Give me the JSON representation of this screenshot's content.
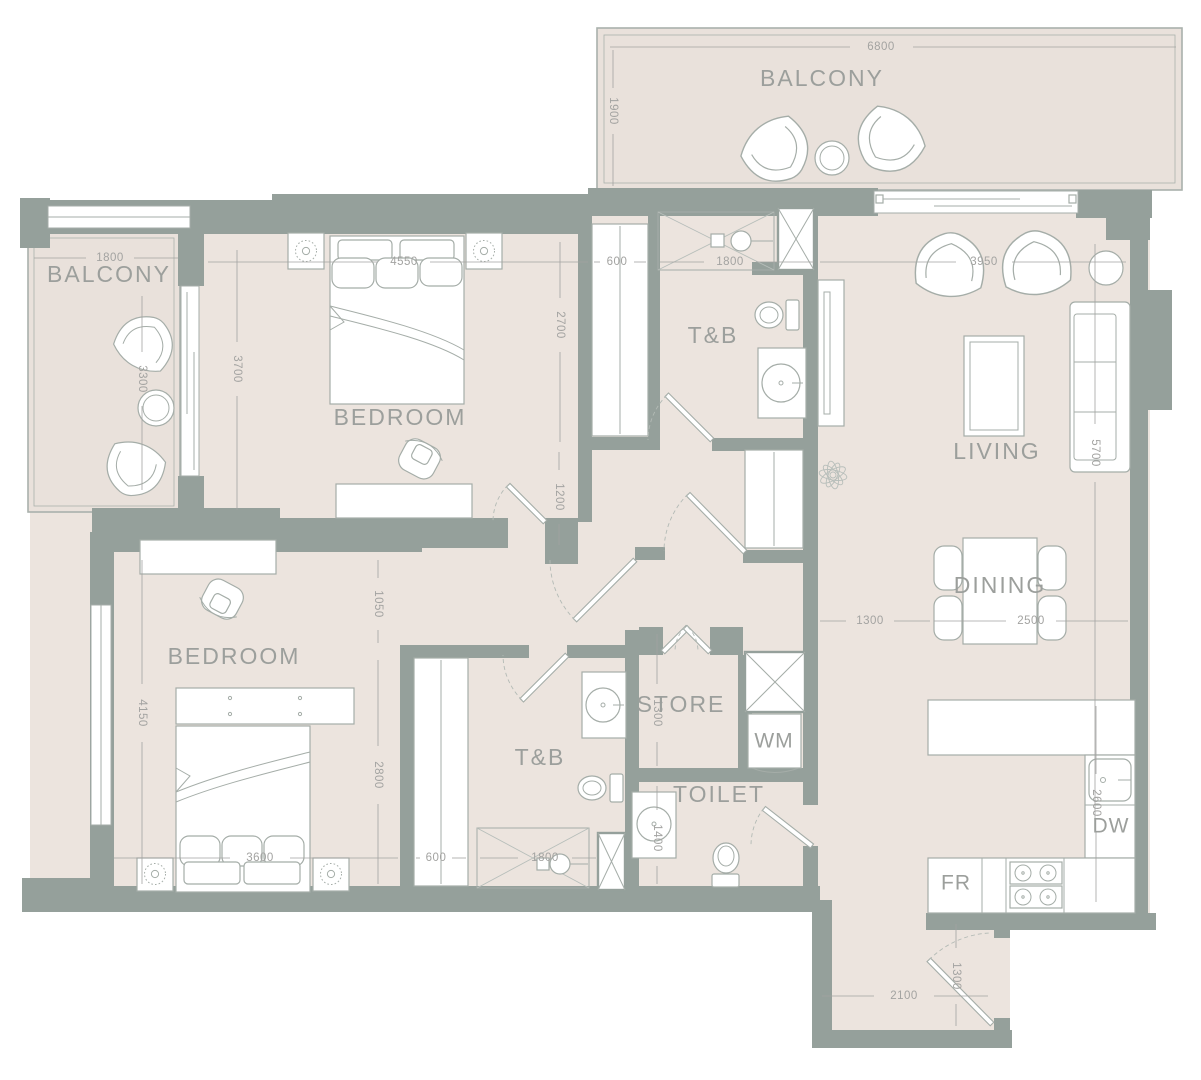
{
  "palette": {
    "wall": "#95a09b",
    "floor": "#ece4de",
    "balcony_floor": "#e9e1db",
    "outline": "#a9b1ac",
    "fixture": "#a5ada8",
    "label": "#9c9f9c",
    "dim": "#a3a3a1"
  },
  "labels": {
    "balcony_top": "BALCONY",
    "balcony_left": "BALCONY",
    "bedroom1": "BEDROOM",
    "bedroom2": "BEDROOM",
    "tb1": "T&B",
    "tb2": "T&B",
    "living": "LIVING",
    "dining": "DINING",
    "store": "STORE",
    "toilet": "TOILET",
    "wm": "WM",
    "dw": "DW",
    "fr": "FR"
  },
  "dims": {
    "balcony_top_width": "6800",
    "balcony_top_depth": "1900",
    "balcony_left_width": "1800",
    "balcony_left_depth": "3300",
    "bedroom1_balcony_side": "3700",
    "bedroom1_width": "4550",
    "bedroom1_depth": "2700",
    "hall_width": "1200",
    "wardrobe1_depth": "600",
    "tb1_width": "1800",
    "living_width": "3950",
    "living_depth": "5700",
    "dining_offset": "1300",
    "dining_width": "2500",
    "bedroom2_depth": "4150",
    "bedroom2_nook": "1050",
    "bedroom2_inner": "2800",
    "bedroom2_width": "3600",
    "wardrobe2_width": "600",
    "tb2_width": "1800",
    "store_depth": "1300",
    "toilet_depth": "1400",
    "kitchen_depth": "2600",
    "entry_width": "2100",
    "entry_depth": "1300"
  }
}
